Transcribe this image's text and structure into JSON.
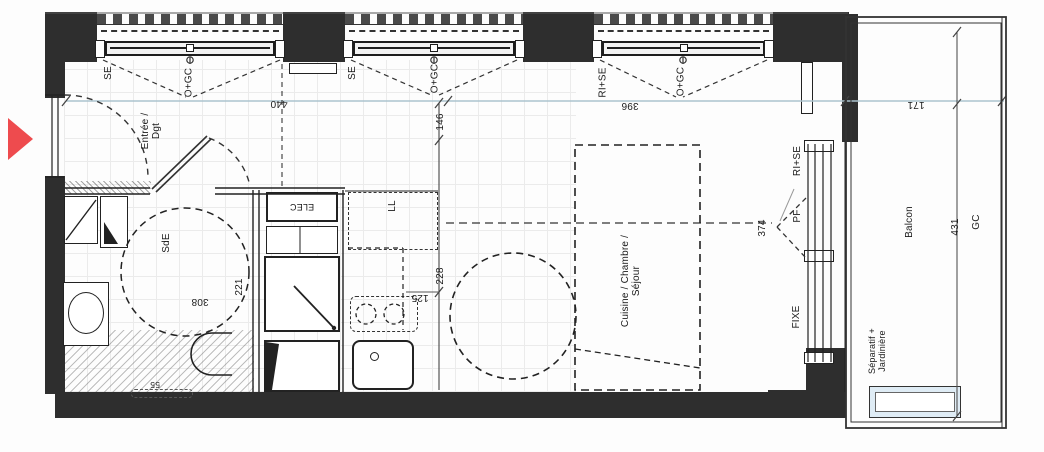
{
  "colors": {
    "wall": "#2e2e2e",
    "entry_arrow_red": "#ee4b4e",
    "dimension_line_blue": "#abc3ce",
    "planter_blue": "#dfecf5",
    "line": "#222222"
  },
  "rooms": {
    "entrance": "Entrée /\nDgt",
    "shower": "SdE",
    "main": "Cuisine / Chambre /\nSéjour",
    "balcony": "Balcon"
  },
  "windows": {
    "w1_type": "SE",
    "w1_opening": "O+GC",
    "w2_type": "SE",
    "w2_opening": "O+GC",
    "w3_type": "RI+SE",
    "w3_opening": "O+GC"
  },
  "bay": {
    "label": "RI+SE",
    "door": "PF",
    "fixed": "FIXE"
  },
  "equipment": {
    "washer": "LL",
    "elec": "ELEC",
    "duct": "GC",
    "separator": "Séparatif +\nJardinière"
  },
  "dims": {
    "facade_left": "440",
    "kitchen_top": "146",
    "facade_right": "396",
    "balcony_width": "171",
    "balcony_length": "431",
    "bay_width": "374",
    "shower_width": "308",
    "shower_depth": "221",
    "kitchen_width": "125",
    "kitchen_depth": "228",
    "shower_step": "55"
  }
}
